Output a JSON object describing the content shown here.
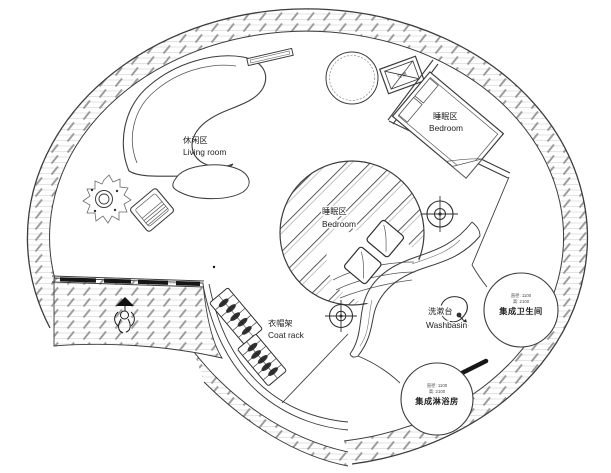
{
  "drawing": {
    "type": "circular tiny-house floor plan",
    "areas": {
      "living_room": {
        "label_zh": "休闲区",
        "label_en": "Living room"
      },
      "bedroom_upper": {
        "label_zh": "睡眠区",
        "label_en": "Bedroom"
      },
      "bedroom_center": {
        "label_zh": "睡眠区",
        "label_en": "Bedroom"
      },
      "coat_rack": {
        "label_zh": "衣帽架",
        "label_en": "Coat rack"
      },
      "washbasin": {
        "label_zh": "洗漱台",
        "label_en": "Washbasin"
      },
      "bathroom_pod": {
        "label_zh": "集成卫生间",
        "dim_line1": "直径: 1100",
        "dim_line2": "高: 2100"
      },
      "shower_pod": {
        "label_zh": "集成淋浴房",
        "dim_line1": "直径: 1100",
        "dim_line2": "高: 2100"
      },
      "ac_unit": {
        "label_zh": "空调"
      }
    },
    "colors": {
      "line": "#3c3c3c",
      "hatch_tick": "#9c9c9c",
      "hatch_grid": "#d4d4d4",
      "glazing": "#151515",
      "background": "#ffffff",
      "text": "#222222"
    }
  }
}
